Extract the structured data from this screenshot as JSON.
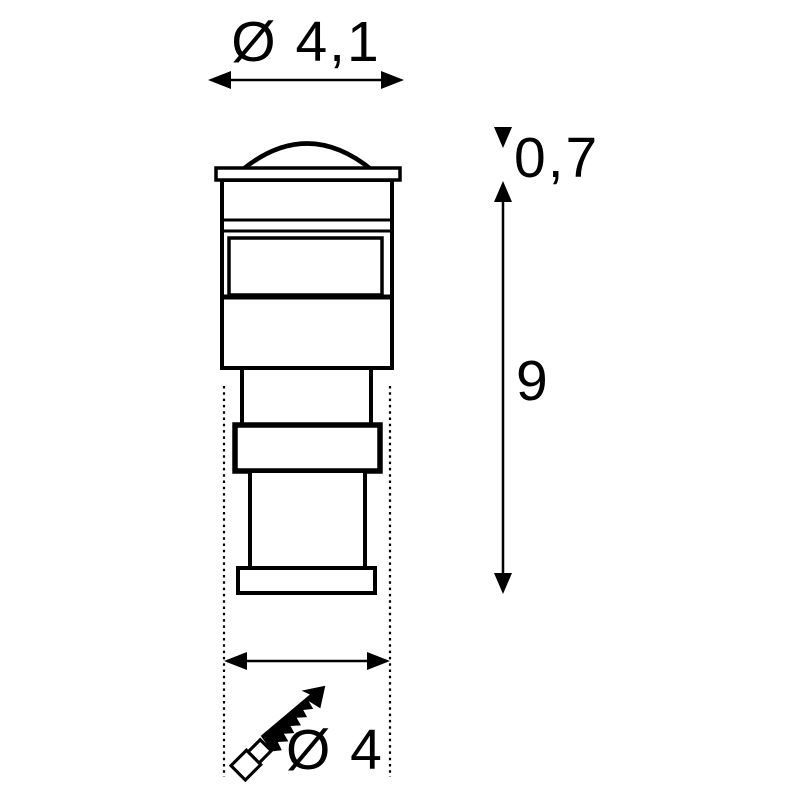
{
  "diagram": {
    "background_color": "#ffffff",
    "line_color": "#000000",
    "dimension_labels": {
      "top_diameter": "Ø 4,1",
      "cap_height": "0,7",
      "body_height": "9",
      "bottom_diameter": "Ø 4"
    },
    "symbols": [
      {
        "name": "saw-icon"
      }
    ]
  }
}
